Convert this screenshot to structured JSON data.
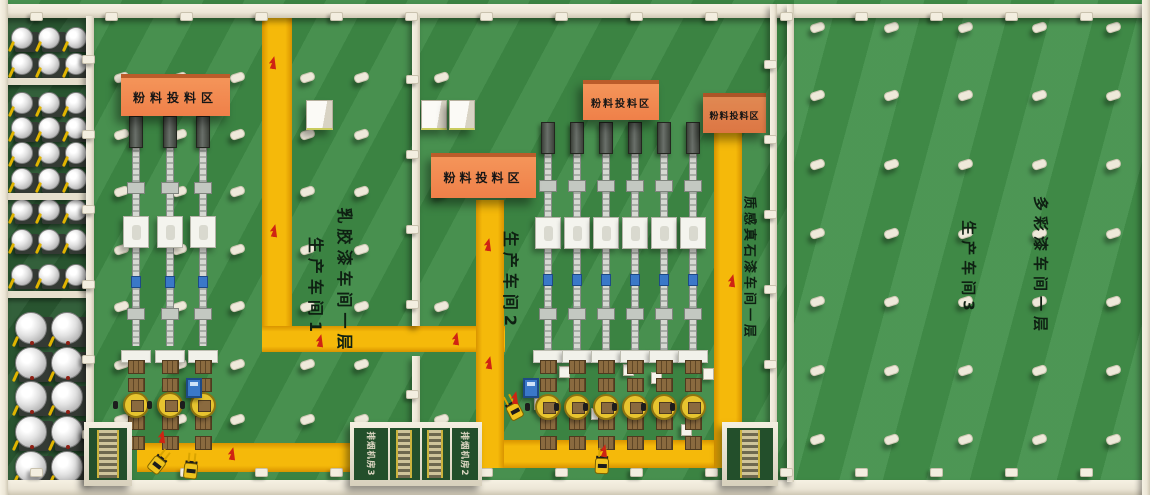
{
  "signs": [
    {
      "label": "粉料投料区"
    },
    {
      "label": "粉料投料区"
    },
    {
      "label": "粉料投料区"
    },
    {
      "label": "粉料投料区"
    }
  ],
  "floor_labels": [
    {
      "text": "乳胶漆车间一层"
    },
    {
      "text": "生产车间1"
    },
    {
      "text": "生产车间2"
    },
    {
      "text": "质感真石漆车间一层"
    },
    {
      "text": "多彩漆车间一层"
    },
    {
      "text": "生产车间3"
    }
  ],
  "room_labels": [
    {
      "text": "排烟机房3"
    },
    {
      "text": "排烟机房2"
    }
  ],
  "colors": {
    "floor": "#3e8a46",
    "floor_ws3": "#42904a",
    "tank_area_floor": "#2b5a33",
    "room_floor": "#234f2b",
    "wall": "#ece6d6",
    "path_yellow": "#f5b90a",
    "sign_bg": "#ef8049",
    "sign_text": "#161616",
    "label_text": "#0e2012",
    "red_mark": "#cf2413",
    "pallet_brown": "#8a6a3f",
    "turntable_yellow": "#e7c42f",
    "machine_blue": "#3a78c8",
    "forklift_yellow": "#efc31d"
  },
  "equipment_counts": {
    "small_mixing_tanks": 27,
    "large_mixing_tanks": 10,
    "workshop1_lines": 3,
    "workshop2_lines": 6,
    "forklifts": 4
  }
}
